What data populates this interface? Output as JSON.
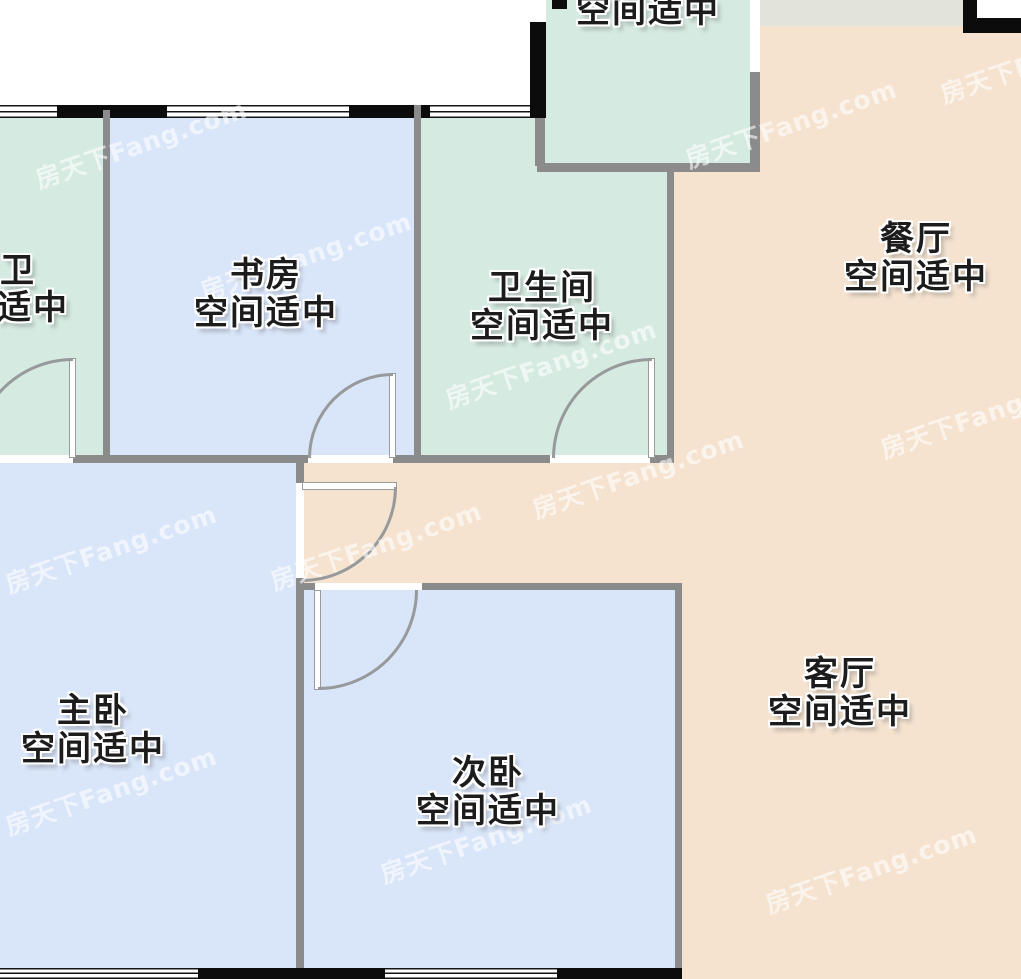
{
  "rooms": {
    "top": {
      "status": "空间适中"
    },
    "wei": {
      "name": "卫",
      "status": "适中"
    },
    "study": {
      "name": "书房",
      "status": "空间适中"
    },
    "bath": {
      "name": "卫生间",
      "status": "空间适中"
    },
    "dining": {
      "name": "餐厅",
      "status": "空间适中"
    },
    "master": {
      "name": "主卧",
      "status": "空间适中"
    },
    "second": {
      "name": "次卧",
      "status": "空间适中"
    },
    "living": {
      "name": "客厅",
      "status": "空间适中"
    }
  },
  "colors": {
    "room_green": "#d5eae1",
    "room_blue": "#d9e5f9",
    "room_peach": "#f5e3d0",
    "strip_gray_green": "#e2e3da",
    "wall_gray": "#8b8b8b",
    "wall_black": "#0c0c0c",
    "label_text": "#1c1c1c"
  },
  "watermark": {
    "text": "房天下Fang.com",
    "positions": [
      {
        "x": 30,
        "y": 125
      },
      {
        "x": 195,
        "y": 237
      },
      {
        "x": 680,
        "y": 105
      },
      {
        "x": 935,
        "y": 40
      },
      {
        "x": 440,
        "y": 345
      },
      {
        "x": 527,
        "y": 455
      },
      {
        "x": 0,
        "y": 530
      },
      {
        "x": 265,
        "y": 527
      },
      {
        "x": 875,
        "y": 395
      },
      {
        "x": 0,
        "y": 772
      },
      {
        "x": 375,
        "y": 820
      },
      {
        "x": 760,
        "y": 850
      }
    ]
  }
}
